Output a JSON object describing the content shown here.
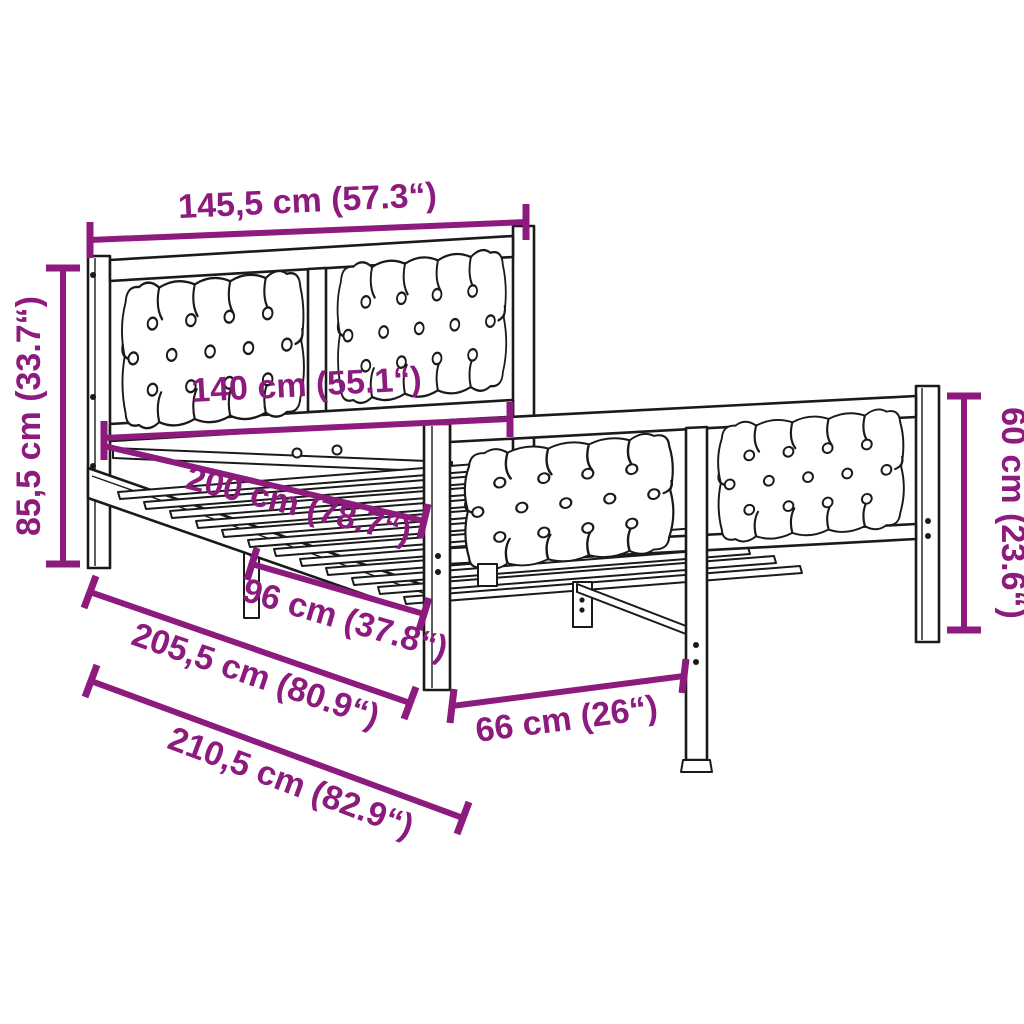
{
  "diagram": {
    "type": "product-dimension-drawing",
    "subject": "bed frame with upholstered headboard and footboard",
    "background_color": "#ffffff",
    "outline_color": "#1a1a1a",
    "accent_color": "#8D1A7D",
    "dimensions": {
      "headboard_width_overall": "145,5 cm (57.3“)",
      "headboard_height": "85,5 cm (33.7“)",
      "inner_width": "140 cm (55.1“)",
      "inner_length": "200 cm (78.7“)",
      "support_span": "96 cm (37.8“)",
      "frame_length": "205,5 cm (80.9“)",
      "overall_length": "210,5 cm (82.9“)",
      "footboard_height": "60 cm (23.6“)",
      "foot_inner_width": "66 cm (26“)"
    }
  }
}
